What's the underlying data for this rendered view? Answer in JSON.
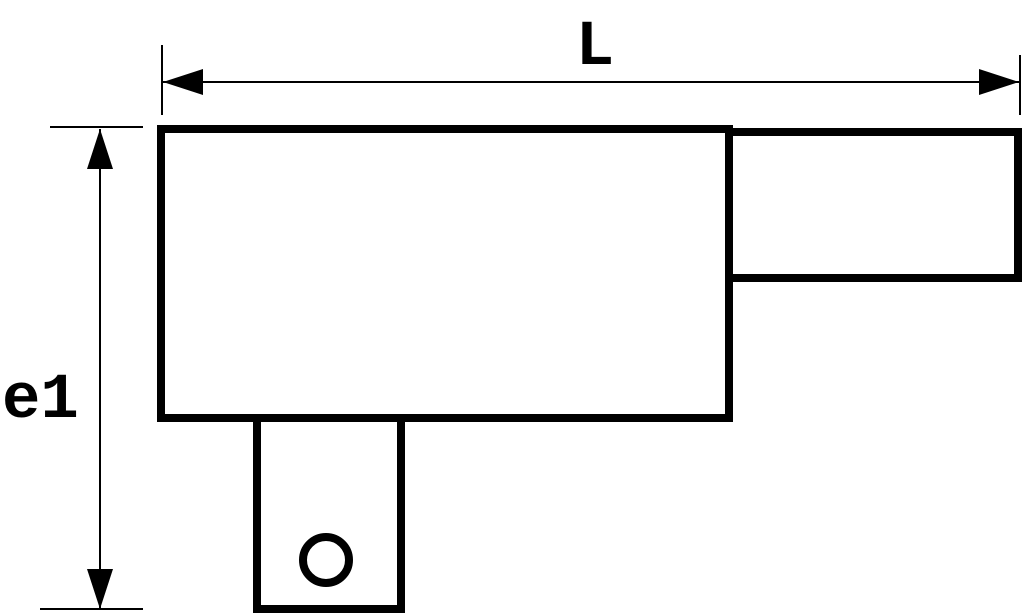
{
  "drawing": {
    "labels": {
      "length_dim": "L",
      "height_dim": "e1"
    },
    "colors": {
      "line": "#000000",
      "background": "#ffffff"
    }
  }
}
